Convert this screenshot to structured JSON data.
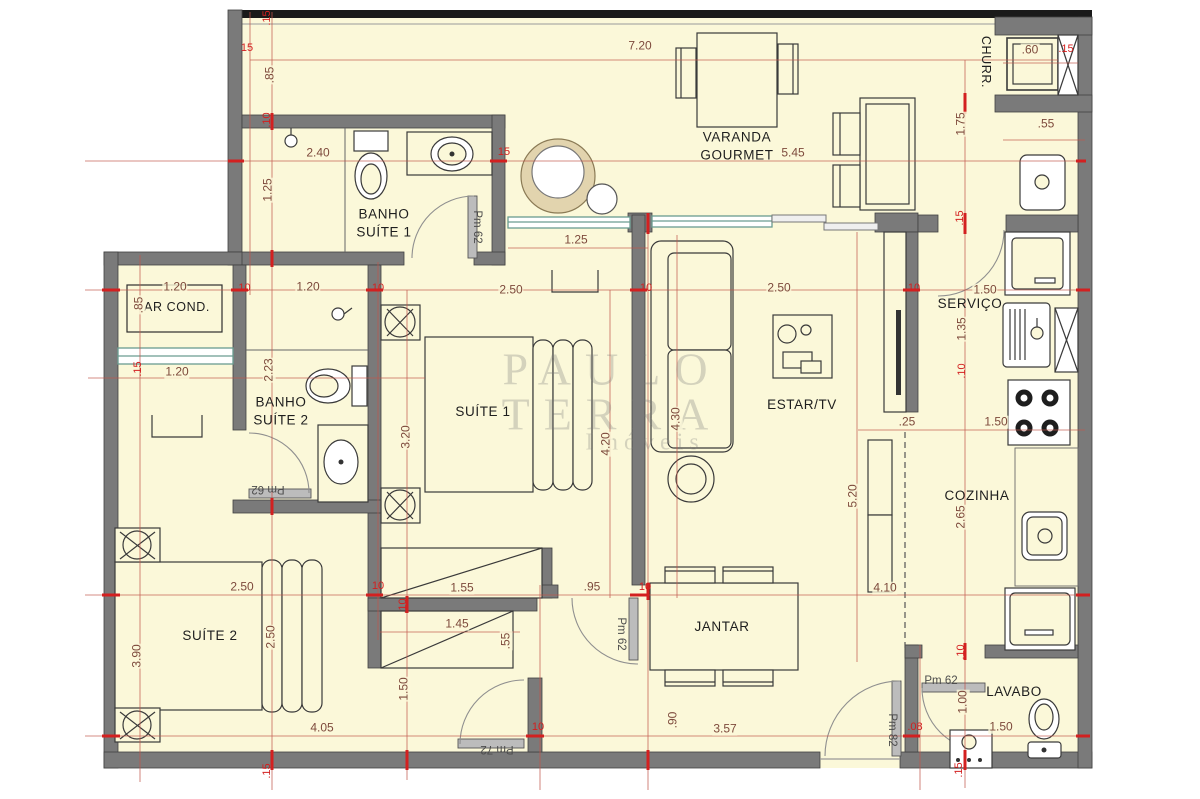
{
  "watermark": {
    "line1": "PAULO",
    "line2": "TERRA",
    "line3": "Imóveis"
  },
  "colors": {
    "floor": "#fbf8d9",
    "wall": "#7a7a7a",
    "railing": "#1a1a1a",
    "window": "#6a9c90",
    "dimension_line": "#c0564b",
    "dimension_text": "#7d4a3c",
    "wall_thickness_text": "#d31f1f",
    "label_text": "#1e1e1e"
  },
  "rooms": [
    {
      "id": "varanda-gourmet",
      "label": "VARANDA\nGOURMET",
      "x": 737,
      "y": 146,
      "cls": ""
    },
    {
      "id": "churrasqueira",
      "label": "CHURR.",
      "x": 986,
      "y": 62,
      "cls": "small rot90"
    },
    {
      "id": "banho-suite-1",
      "label": "BANHO\nSUÍTE 1",
      "x": 384,
      "y": 223,
      "cls": ""
    },
    {
      "id": "ar-cond",
      "label": "AR COND.",
      "x": 177,
      "y": 307,
      "cls": "small"
    },
    {
      "id": "banho-suite-2",
      "label": "BANHO\nSUÍTE 2",
      "x": 281,
      "y": 411,
      "cls": ""
    },
    {
      "id": "suite-1",
      "label": "SUÍTE 1",
      "x": 483,
      "y": 412,
      "cls": ""
    },
    {
      "id": "estar-tv",
      "label": "ESTAR/TV",
      "x": 802,
      "y": 405,
      "cls": ""
    },
    {
      "id": "servico",
      "label": "SERVIÇO",
      "x": 970,
      "y": 304,
      "cls": ""
    },
    {
      "id": "cozinha",
      "label": "COZINHA",
      "x": 977,
      "y": 496,
      "cls": ""
    },
    {
      "id": "suite-2",
      "label": "SUÍTE 2",
      "x": 210,
      "y": 636,
      "cls": ""
    },
    {
      "id": "jantar",
      "label": "JANTAR",
      "x": 722,
      "y": 627,
      "cls": ""
    },
    {
      "id": "lavabo",
      "label": "LAVABO",
      "x": 1014,
      "y": 692,
      "cls": ""
    }
  ],
  "dimensions": [
    {
      "t": "7.20",
      "x": 640,
      "y": 46,
      "k": "main",
      "r": 0
    },
    {
      "t": ".85",
      "x": 270,
      "y": 75,
      "k": "main",
      "r": 1
    },
    {
      "t": "2.40",
      "x": 318,
      "y": 153,
      "k": "main",
      "r": 0
    },
    {
      "t": "1.25",
      "x": 268,
      "y": 190,
      "k": "main",
      "r": 1
    },
    {
      "t": "5.45",
      "x": 793,
      "y": 153,
      "k": "main",
      "r": 0
    },
    {
      "t": "1.75",
      "x": 961,
      "y": 124,
      "k": "main",
      "r": 1
    },
    {
      "t": ".60",
      "x": 1030,
      "y": 50,
      "k": "main",
      "r": 0
    },
    {
      "t": ".55",
      "x": 1046,
      "y": 124,
      "k": "main",
      "r": 0
    },
    {
      "t": "1.25",
      "x": 576,
      "y": 240,
      "k": "main",
      "r": 0
    },
    {
      "t": "1.20",
      "x": 175,
      "y": 287,
      "k": "main",
      "r": 0
    },
    {
      "t": "1.20",
      "x": 308,
      "y": 287,
      "k": "main",
      "r": 0
    },
    {
      "t": "2.50",
      "x": 511,
      "y": 290,
      "k": "main",
      "r": 0
    },
    {
      "t": "2.50",
      "x": 779,
      "y": 288,
      "k": "main",
      "r": 0
    },
    {
      "t": "1.50",
      "x": 985,
      "y": 290,
      "k": "main",
      "r": 0
    },
    {
      "t": ".85",
      "x": 139,
      "y": 305,
      "k": "main",
      "r": 1
    },
    {
      "t": "2.23",
      "x": 269,
      "y": 370,
      "k": "main",
      "r": 1
    },
    {
      "t": "1.20",
      "x": 177,
      "y": 372,
      "k": "main",
      "r": 0
    },
    {
      "t": "3.20",
      "x": 406,
      "y": 437,
      "k": "main",
      "r": 1
    },
    {
      "t": "4.20",
      "x": 606,
      "y": 444,
      "k": "main",
      "r": 1
    },
    {
      "t": "4.30",
      "x": 676,
      "y": 419,
      "k": "main",
      "r": 1
    },
    {
      "t": "1.35",
      "x": 962,
      "y": 329,
      "k": "main",
      "r": 1
    },
    {
      "t": "1.50",
      "x": 996,
      "y": 422,
      "k": "main",
      "r": 0
    },
    {
      "t": ".25",
      "x": 907,
      "y": 422,
      "k": "main",
      "r": 0
    },
    {
      "t": "2.65",
      "x": 961,
      "y": 517,
      "k": "main",
      "r": 1
    },
    {
      "t": "5.20",
      "x": 853,
      "y": 496,
      "k": "main",
      "r": 1
    },
    {
      "t": "2.50",
      "x": 242,
      "y": 587,
      "k": "main",
      "r": 0
    },
    {
      "t": "2.50",
      "x": 271,
      "y": 637,
      "k": "main",
      "r": 1
    },
    {
      "t": "3.90",
      "x": 137,
      "y": 656,
      "k": "main",
      "r": 1
    },
    {
      "t": "1.55",
      "x": 462,
      "y": 588,
      "k": "main",
      "r": 0
    },
    {
      "t": ".95",
      "x": 592,
      "y": 587,
      "k": "main",
      "r": 0
    },
    {
      "t": "1.45",
      "x": 457,
      "y": 624,
      "k": "main",
      "r": 0
    },
    {
      "t": ".55",
      "x": 506,
      "y": 641,
      "k": "main",
      "r": 1
    },
    {
      "t": "1.50",
      "x": 404,
      "y": 689,
      "k": "main",
      "r": 1
    },
    {
      "t": "4.10",
      "x": 885,
      "y": 588,
      "k": "main",
      "r": 0
    },
    {
      "t": "4.05",
      "x": 322,
      "y": 728,
      "k": "main",
      "r": 0
    },
    {
      "t": ".90",
      "x": 673,
      "y": 720,
      "k": "main",
      "r": 1
    },
    {
      "t": "3.57",
      "x": 725,
      "y": 729,
      "k": "main",
      "r": 0
    },
    {
      "t": "1.00",
      "x": 963,
      "y": 702,
      "k": "main",
      "r": 1
    },
    {
      "t": "1.50",
      "x": 1001,
      "y": 727,
      "k": "main",
      "r": 0
    },
    {
      "t": ".15",
      "x": 268,
      "y": 18,
      "k": "small",
      "r": 1
    },
    {
      "t": "15",
      "x": 247,
      "y": 49,
      "k": "small",
      "r": 0
    },
    {
      "t": ".10",
      "x": 268,
      "y": 120,
      "k": "small",
      "r": 1
    },
    {
      "t": "15",
      "x": 504,
      "y": 153,
      "k": "small",
      "r": 0
    },
    {
      "t": ".15",
      "x": 1066,
      "y": 50,
      "k": "small",
      "r": 0
    },
    {
      "t": ".15",
      "x": 961,
      "y": 218,
      "k": "small",
      "r": 1
    },
    {
      "t": ".10",
      "x": 243,
      "y": 289,
      "k": "small",
      "r": 0
    },
    {
      "t": "10",
      "x": 378,
      "y": 289,
      "k": "small",
      "r": 0
    },
    {
      "t": "10",
      "x": 646,
      "y": 289,
      "k": "small",
      "r": 0
    },
    {
      "t": "10",
      "x": 914,
      "y": 289,
      "k": "small",
      "r": 0
    },
    {
      "t": ".15",
      "x": 139,
      "y": 369,
      "k": "small",
      "r": 1
    },
    {
      "t": ".10",
      "x": 963,
      "y": 371,
      "k": "small",
      "r": 1
    },
    {
      "t": "10",
      "x": 378,
      "y": 587,
      "k": "small",
      "r": 0
    },
    {
      "t": "10",
      "x": 645,
      "y": 588,
      "k": "small",
      "r": 0
    },
    {
      "t": ".10",
      "x": 404,
      "y": 606,
      "k": "small",
      "r": 1
    },
    {
      "t": ".10",
      "x": 962,
      "y": 652,
      "k": "small",
      "r": 1
    },
    {
      "t": "10",
      "x": 538,
      "y": 728,
      "k": "small",
      "r": 0
    },
    {
      "t": ".08",
      "x": 915,
      "y": 728,
      "k": "small",
      "r": 0
    },
    {
      "t": ".15",
      "x": 268,
      "y": 771,
      "k": "small",
      "r": 1
    },
    {
      "t": ".15",
      "x": 960,
      "y": 770,
      "k": "small",
      "r": 1
    }
  ],
  "doors": [
    {
      "t": "Pm 62",
      "x": 477,
      "y": 227,
      "rot": "rot90"
    },
    {
      "t": "Pm 62",
      "x": 268,
      "y": 489,
      "rot": "rot180"
    },
    {
      "t": "Pm 62",
      "x": 621,
      "y": 634,
      "rot": "rot90"
    },
    {
      "t": "Pm 72",
      "x": 497,
      "y": 749,
      "rot": "rot180"
    },
    {
      "t": "Pm 82",
      "x": 892,
      "y": 730,
      "rot": "rot90"
    },
    {
      "t": "Pm 62",
      "x": 941,
      "y": 681,
      "rot": ""
    }
  ]
}
